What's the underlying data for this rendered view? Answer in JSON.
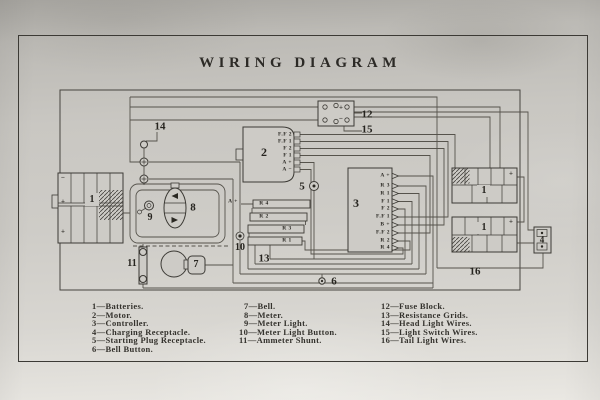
{
  "title": "WIRING DIAGRAM",
  "colors": {
    "paper": "#cdcbc6",
    "ink": "#2c2a26",
    "wire": "#55524b"
  },
  "diagram": {
    "labels": {
      "battery_left": "1",
      "battery_right_top": "1",
      "battery_right_bottom": "1",
      "motor": "2",
      "controller": "3",
      "charging_receptacle": "4",
      "starting_plug": "5",
      "bell_button": "6",
      "bell": "7",
      "meter": "8",
      "meter_light": "9",
      "meter_light_button": "10",
      "ammeter_shunt": "11",
      "fuse_block": "12",
      "resistance_grids": "13",
      "head_light_wires": "14",
      "light_switch_wires": "15",
      "tail_light_wires": "16"
    },
    "motor_terminals": [
      "F.F 2",
      "F.F 1",
      "F 2",
      "F 1",
      "A +",
      "A −"
    ],
    "controller_terminals": [
      "A +",
      "R 3",
      "R 1",
      "F 1",
      "F 2",
      "F.F 1",
      "B +",
      "F.F 2",
      "R 2",
      "R 4"
    ],
    "grid": {
      "feed": "A +",
      "bar1": "R 4",
      "bar2": "R 2",
      "bar3": "R 3",
      "bar4": "R 1"
    },
    "marks": {
      "plus": "+",
      "minus": "−"
    }
  },
  "legend": {
    "col1": [
      "1—Batteries.",
      "2—Motor.",
      "3—Controller.",
      "4—Charging Receptacle.",
      "5—Starting Plug Receptacle.",
      "6—Bell Button."
    ],
    "col2": [
      "7—Bell.",
      "8—Meter.",
      "9—Meter Light.",
      "10—Meter Light Button.",
      "11—Ammeter Shunt."
    ],
    "col3": [
      "12—Fuse Block.",
      "13—Resistance Grids.",
      "14—Head Light Wires.",
      "15—Light Switch Wires.",
      "16—Tail Light Wires."
    ]
  }
}
